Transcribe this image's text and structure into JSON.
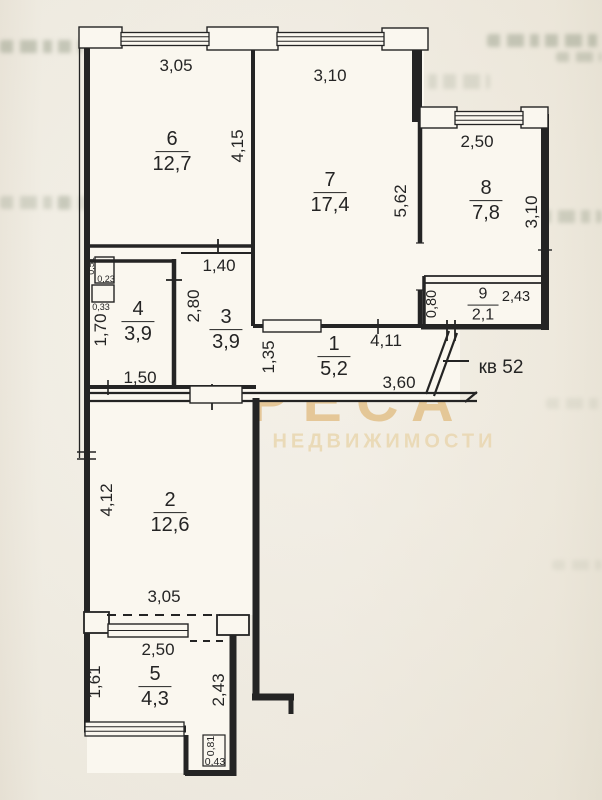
{
  "watermark": {
    "brand": "АДРЕСА",
    "tagline": "АГЕНТСТВО НЕДВИЖИМОСТИ",
    "brand_color": "#e2bf87",
    "tagline_color": "#ead8b3",
    "logo_circle_color": "#f3e2bf"
  },
  "plan": {
    "ink_color": "#242424",
    "paper_color": "#f0ebe1",
    "unit_label": "кв 52",
    "rooms": {
      "r1": {
        "number": "1",
        "area": "5,2"
      },
      "r2": {
        "number": "2",
        "area": "12,6"
      },
      "r3": {
        "number": "3",
        "area": "3,9"
      },
      "r4": {
        "number": "4",
        "area": "3,9"
      },
      "r5": {
        "number": "5",
        "area": "4,3"
      },
      "r6": {
        "number": "6",
        "area": "12,7"
      },
      "r7": {
        "number": "7",
        "area": "17,4"
      },
      "r8": {
        "number": "8",
        "area": "7,8"
      },
      "r9": {
        "number": "9",
        "area": "2,1"
      }
    },
    "dimensions": {
      "room6_width": "3,05",
      "room6_depth": "4,15",
      "room7_width": "3,10",
      "room7_depth": "5,62",
      "room8_width": "2,50",
      "room8_depth": "3,10",
      "room9_height": "0,80",
      "room9_width": "2,43",
      "room3_width": "1,40",
      "room3_depth": "2,80",
      "room4_depth": "1,70",
      "room4_width": "1,50",
      "shaft_depth": "0,51",
      "shaft_width": "0,23",
      "shaft2_width": "0,33",
      "hall_left": "1,35",
      "hall_top": "4,11",
      "hall_bottom": "3,60",
      "room2_depth": "4,12",
      "room2_width": "3,05",
      "room5_width": "2,50",
      "room5_left": "1,61",
      "room5_right": "2,43",
      "step_depth": "0,81",
      "step_width": "0,43"
    }
  }
}
